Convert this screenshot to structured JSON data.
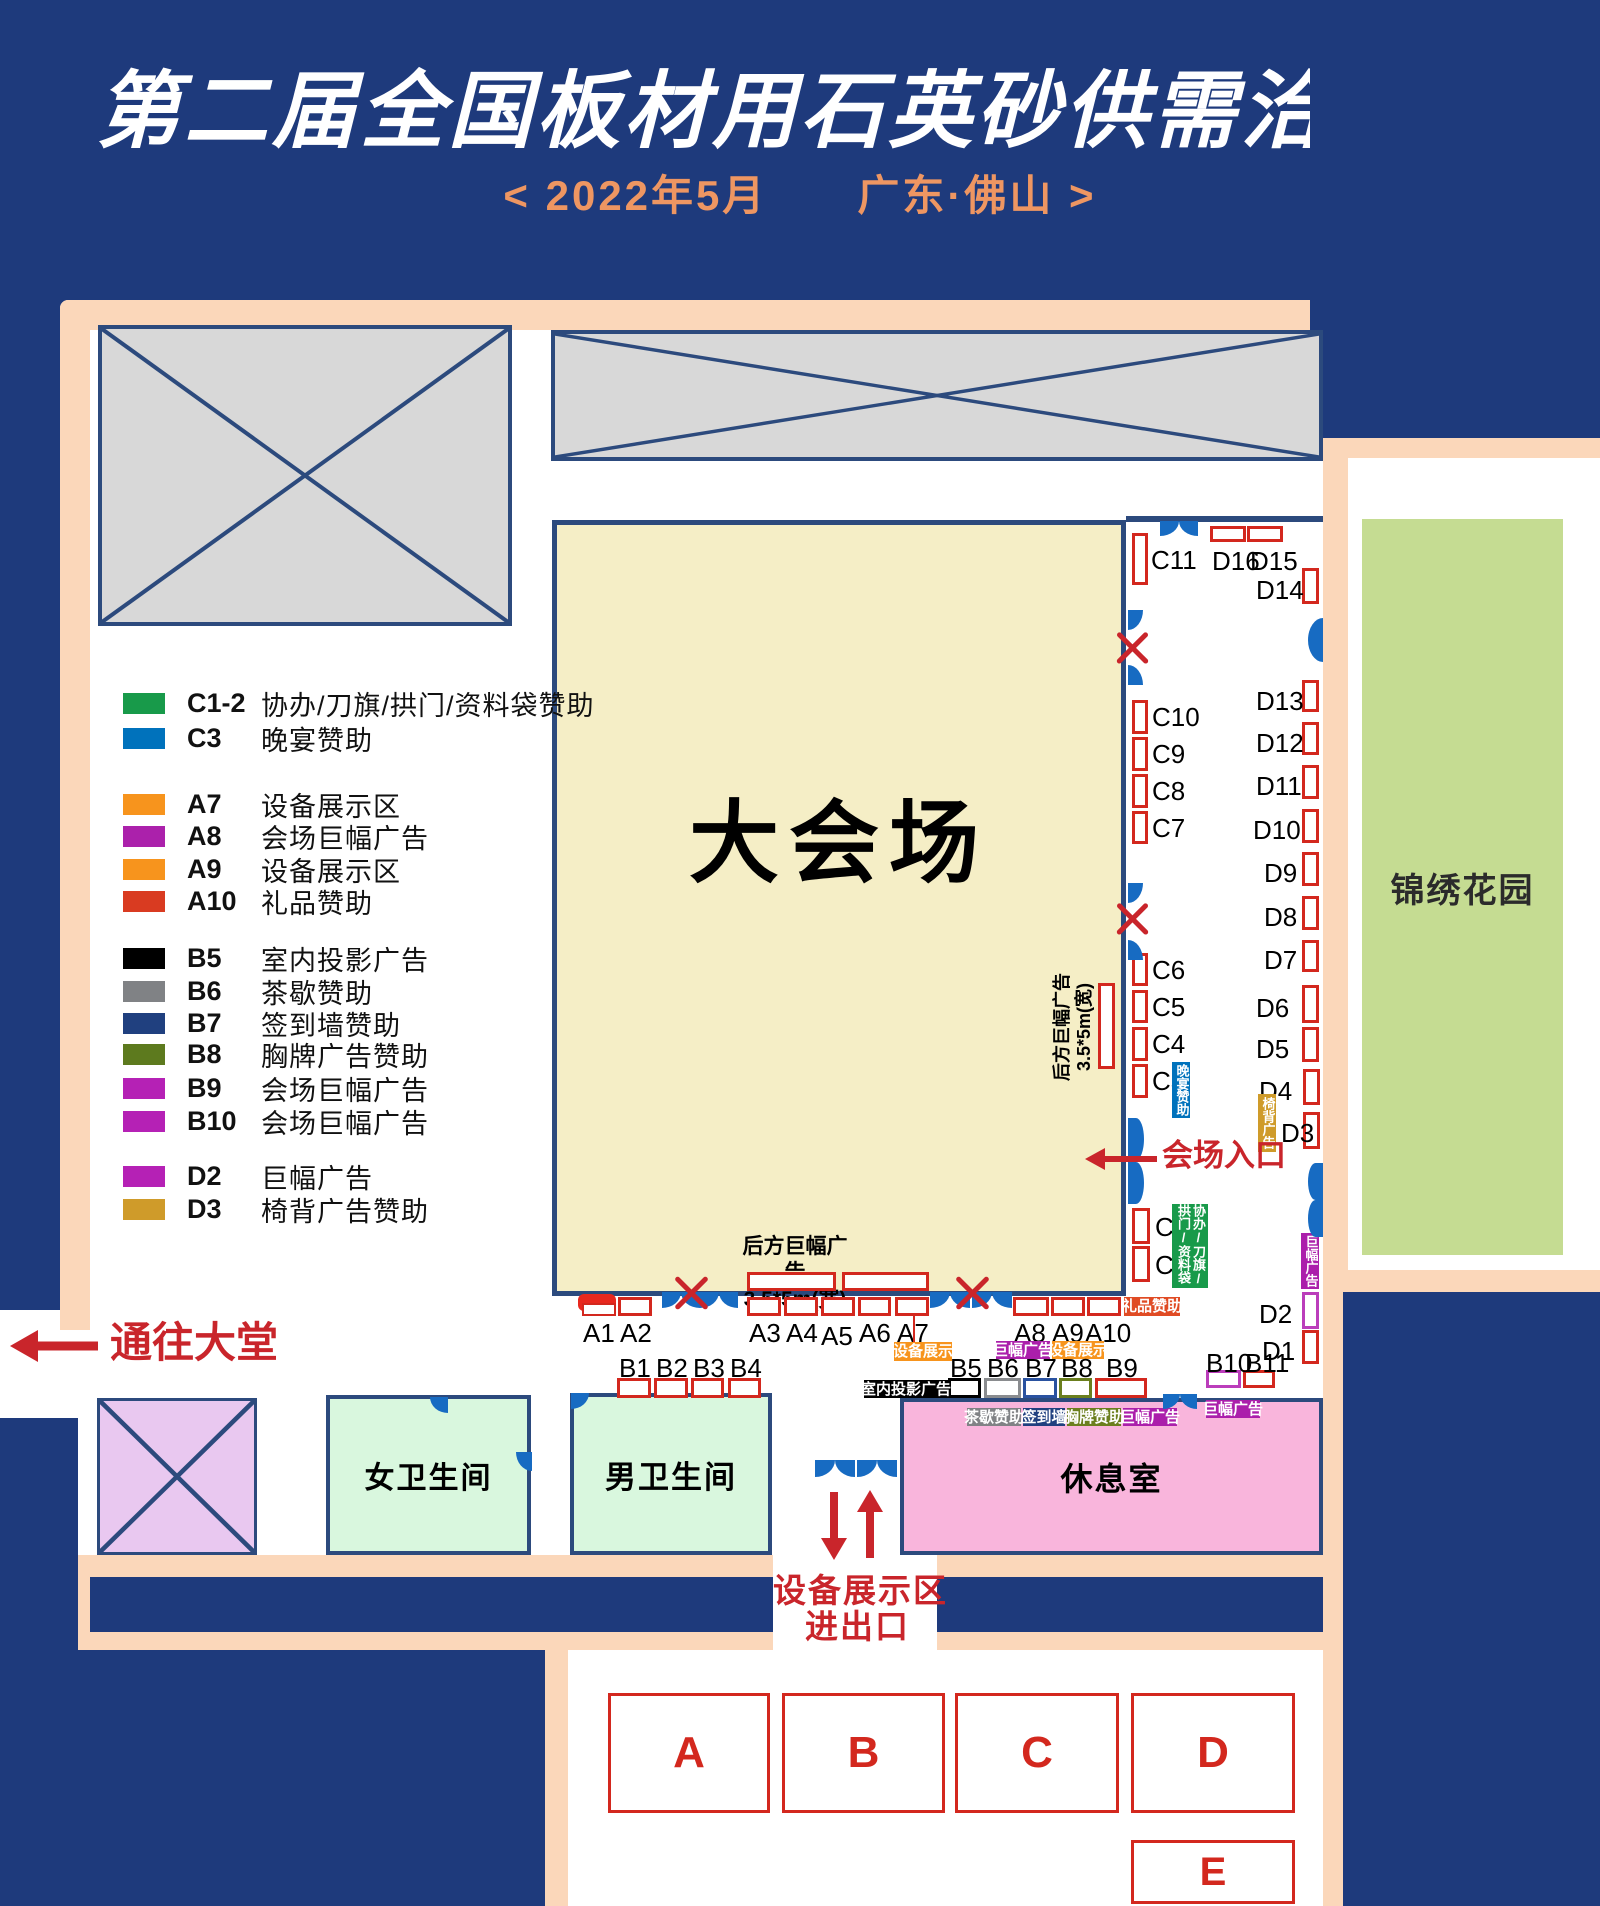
{
  "header": {
    "title": "第二届全国板材用石英砂供需洽谈会",
    "subtitle": "<  2022年5月　　广东·佛山  >"
  },
  "legend": [
    {
      "id": "C1-2",
      "label": "协办/刀旗/拱门/资料袋赞助",
      "color": "#189a4a"
    },
    {
      "id": "C3",
      "label": "晚宴赞助",
      "color": "#0072bc"
    },
    {
      "id": "A7",
      "label": "设备展示区",
      "color": "#f7941d"
    },
    {
      "id": "A8",
      "label": "会场巨幅广告",
      "color": "#ab21ab"
    },
    {
      "id": "A9",
      "label": "设备展示区",
      "color": "#f7941d"
    },
    {
      "id": "A10",
      "label": "礼品赞助",
      "color": "#d93b21"
    },
    {
      "id": "B5",
      "label": "室内投影广告",
      "color": "#000000"
    },
    {
      "id": "B6",
      "label": "茶歇赞助",
      "color": "#808285"
    },
    {
      "id": "B7",
      "label": "签到墙赞助",
      "color": "#20407f"
    },
    {
      "id": "B8",
      "label": "胸牌广告赞助",
      "color": "#5d7a1e"
    },
    {
      "id": "B9",
      "label": "会场巨幅广告",
      "color": "#b521b5"
    },
    {
      "id": "B10",
      "label": "会场巨幅广告",
      "color": "#b521b5"
    },
    {
      "id": "D2",
      "label": "巨幅广告",
      "color": "#b521b5"
    },
    {
      "id": "D3",
      "label": "椅背广告赞助",
      "color": "#cf9b2a"
    }
  ],
  "areas": {
    "hall": "大会场",
    "garden": "锦绣花园",
    "women_wc": "女卫生间",
    "men_wc": "男卫生间",
    "lounge": "休息室",
    "to_lobby": "通往大堂",
    "entrance": "会场入口",
    "equip_line1": "设备展示区",
    "equip_line2": "进出口",
    "rear_banner_line1": "后方巨幅广告",
    "rear_banner_line2": "3.5*5m(宽)"
  },
  "tags": {
    "dinner": {
      "text": "晚宴赞助",
      "color": "#0072bc"
    },
    "coop": {
      "text": "协办/刀旗/拱门/资料袋",
      "color": "#189a4a"
    },
    "chairback": {
      "text": "椅背广告",
      "color": "#cf9b2a"
    },
    "banner_d2": {
      "text": "巨幅广告",
      "color": "#ab1fab"
    },
    "gift": {
      "text": "礼品赞助",
      "color": "#e04b24"
    },
    "equip_a7": {
      "text": "设备展示",
      "color": "#f7941d"
    },
    "banner_a8": {
      "text": "巨幅广告",
      "color": "#ab1fab"
    },
    "equip_a9": {
      "text": "设备展示",
      "color": "#f7941d"
    },
    "projection": {
      "text": "室内投影广告",
      "color": "#000000"
    },
    "tea": {
      "text": "茶歇赞助",
      "color": "#808285"
    },
    "signwall": {
      "text": "签到墙",
      "color": "#20407f"
    },
    "badge": {
      "text": "胸牌赞助",
      "color": "#6b7f1e"
    },
    "banner_b9": {
      "text": "巨幅广告",
      "color": "#ab1fab"
    },
    "banner_b10": {
      "text": "巨幅广告",
      "color": "#ab1fab"
    }
  },
  "booths": {
    "A1": "A1",
    "A2": "A2",
    "A3": "A3",
    "A4": "A4",
    "A5": "A5",
    "A6": "A6",
    "A7": "A7",
    "A8": "A8",
    "A9": "A9",
    "A10": "A10",
    "B1": "B1",
    "B2": "B2",
    "B3": "B3",
    "B4": "B4",
    "B5": "B5",
    "B6": "B6",
    "B7": "B7",
    "B8": "B8",
    "B9": "B9",
    "B10": "B10",
    "B11": "B11",
    "C1": "C1",
    "C2": "C2",
    "C3": "C3",
    "C4": "C4",
    "C5": "C5",
    "C6": "C6",
    "C7": "C7",
    "C8": "C8",
    "C9": "C9",
    "C10": "C10",
    "C11": "C11",
    "D1": "D1",
    "D2": "D2",
    "D3": "D3",
    "D4": "D4",
    "D5": "D5",
    "D6": "D6",
    "D7": "D7",
    "D8": "D8",
    "D9": "D9",
    "D10": "D10",
    "D11": "D11",
    "D12": "D12",
    "D13": "D13",
    "D14": "D14",
    "D15": "D15",
    "D16": "D16"
  },
  "zones": {
    "A": "A",
    "B": "B",
    "C": "C",
    "D": "D",
    "E": "E"
  }
}
